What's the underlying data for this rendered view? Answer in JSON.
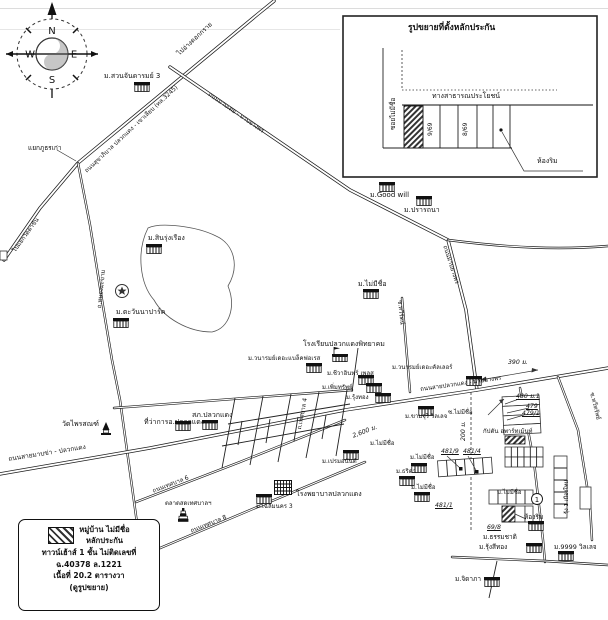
{
  "compass": {
    "n": "N",
    "e": "E",
    "s": "S",
    "w": "W"
  },
  "inset": {
    "title": "รูปขยายที่ตั้งหลักประกัน",
    "soi": "ซอยไม่มีชื่อ",
    "public_way": "ทางสาธารณประโยชน์",
    "plots": [
      "9/69",
      "8/69"
    ],
    "corner_room": "ห้องริม"
  },
  "roads": {
    "hwy_main": "ถนนสุขาภิบาล ปลวกแดง - เขาเลียบ (ทล.3245)",
    "to_reservoir": "ไปอ่างดอกกราย",
    "to_wat_takhan": "ไปแยกวัดตาขัน",
    "junction": "แยกภูธรเก่า",
    "left_vertical": "ถ.หนองมะขาม",
    "mabtoei": "ถนนมาบเตย - มาบยางพร",
    "mabyangporn": "ถนนมาบยางพร",
    "mabkha": "ถนนสายมาบข่า - ปลวกแดง",
    "east": "ถนนสายปลวกแดง - มาบยางพร",
    "tessaban4": "ถ.เทศบาล 4",
    "tessaban6": "ถนนเทศบาล 6",
    "tessaban8": "ถนนเทศบาล 8",
    "soi_taweerat": "ซ.ทวีรัตน์",
    "soi_taweesap": "ซ.ทวีทรัพย์",
    "soi_no_name": "ซ.ไม่มีชื่อ"
  },
  "places": {
    "suanjan": "ม.สวนจันดารมย์ 3",
    "sinrung": "ม.สินรุ่งเรือง",
    "tawanna": "ม.ตะวันนาปาร์ค",
    "goodwill": "ม.Good will",
    "prattana": "ม.ปรารถนา",
    "no_name": "ม.ไม่มีชื่อ",
    "school": "โรงเรียนปลวกแดงพิทยาคม",
    "blackforest": "ม.วนารมย์เดอะแบล็คฟอเรส",
    "cheewain": "ม.ชีวาอินทร์ เพลส",
    "permsap": "ม.เพิ่มทรัพย์",
    "rungthong": "ม.รุ้งทอง",
    "thecolor": "ม.วนารมย์เดอะคัลเลอร์",
    "khamjuree": "ม.ขามจุรี วิลเลจ",
    "captain": "กัปตัน อพาร์ทเม้นท์",
    "premanan": "ม.เปรมอนันต์",
    "chalermnakorn3": "ม.เฉลิมนคร 3",
    "hospital": "โรงพยาบาลปลวกแดง",
    "police": "สภ.ปลวกแดง",
    "district_office": "ที่ว่าการอ.ปลวกแดง",
    "wat": "วัดไพรสณฑ์",
    "market": "ตลาดสดเทศบาลฯ",
    "thrida": "ม.ธริดา",
    "thammachat": "ม.ธรรมชาติ",
    "rungseethong": "ม.รุ้งสีทอง",
    "v9999": "ม.9999 วิลเลจ",
    "jidapa": "ม.จิดาภา",
    "rung1": "รุ้ง 1 เมืองใหม่"
  },
  "numbers": {
    "n480": "480 ม.1",
    "n479": "479",
    "n479_1": "479/1",
    "n481_9": "481/9",
    "n481_4": "481/4",
    "n481_1": "481/1",
    "n69_8": "69/8",
    "circled1": "1"
  },
  "distances": {
    "d390": "390 ม.",
    "d200": "200 ม.",
    "d2600": "2,600 ม."
  },
  "legend": {
    "line1": "หมู่บ้าน ไม่มีชื่อ",
    "line2": "หลักประกัน",
    "line3": "ทาวน์เฮ้าส์ 1 ชั้น ไม่ติดเลขที่",
    "line4": "ฉ.40378 ล.1221",
    "line5": "เนื้อที่ 20.2 ตารางวา",
    "line6": "(ดูรูปขยาย)"
  }
}
